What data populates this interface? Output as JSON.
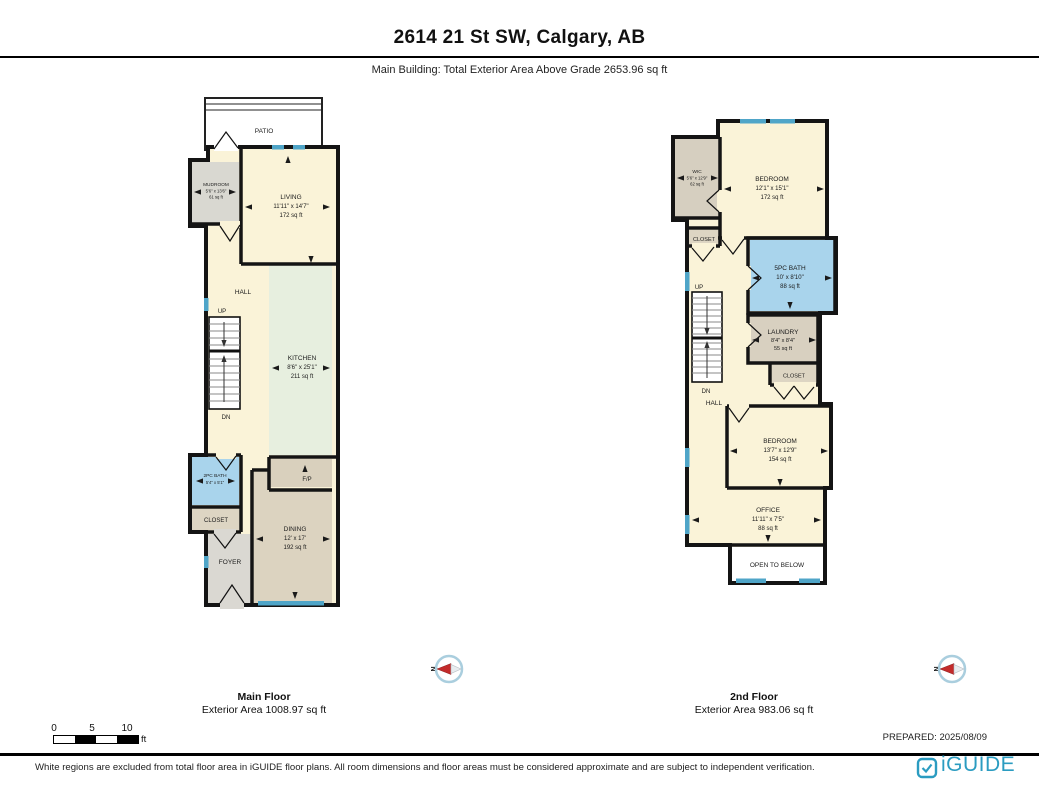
{
  "header": {
    "title": "2614 21 St SW, Calgary, AB",
    "subtitle": "Main Building: Total Exterior Area Above Grade 2653.96 sq ft"
  },
  "floors": {
    "main": {
      "name": "Main Floor",
      "exterior_area": "Exterior Area 1008.97 sq ft",
      "up": "UP",
      "dn": "DN",
      "rooms": {
        "patio": {
          "name": "PATIO"
        },
        "mudroom": {
          "name": "MUDROOM",
          "dims": "5'6\" x 13'6\"",
          "area": "61 sq ft"
        },
        "living": {
          "name": "LIVING",
          "dims": "11'11\" x 14'7\"",
          "area": "172 sq ft"
        },
        "hall": {
          "name": "HALL"
        },
        "kitchen": {
          "name": "KITCHEN",
          "dims": "8'6\" x 25'1\"",
          "area": "211 sq ft"
        },
        "fireplace": {
          "name": "F/P"
        },
        "bath": {
          "name": "2PC BATH",
          "dims": "5'4\" x 5'1\""
        },
        "closet": {
          "name": "CLOSET"
        },
        "foyer": {
          "name": "FOYER"
        },
        "dining": {
          "name": "DINING",
          "dims": "12' x 17'",
          "area": "192 sq ft"
        }
      }
    },
    "second": {
      "name": "2nd Floor",
      "exterior_area": "Exterior Area 983.06 sq ft",
      "up": "UP",
      "dn": "DN",
      "rooms": {
        "wic": {
          "name": "WIC",
          "dims": "5'6\" x 12'9\"",
          "area": "62 sq ft"
        },
        "bedroom1": {
          "name": "BEDROOM",
          "dims": "12'1\" x 15'1\"",
          "area": "172 sq ft"
        },
        "closet1": {
          "name": "CLOSET"
        },
        "bath": {
          "name": "5PC BATH",
          "dims": "10' x 8'10\"",
          "area": "88 sq ft"
        },
        "hall": {
          "name": "HALL"
        },
        "laundry": {
          "name": "LAUNDRY",
          "dims": "8'4\" x 8'4\"",
          "area": "55 sq ft"
        },
        "closet2": {
          "name": "CLOSET"
        },
        "bedroom2": {
          "name": "BEDROOM",
          "dims": "13'7\" x 12'9\"",
          "area": "154 sq ft"
        },
        "office": {
          "name": "OFFICE",
          "dims": "11'11\" x 7'5\"",
          "area": "88 sq ft"
        },
        "open_below": {
          "name": "OPEN TO BELOW"
        }
      }
    }
  },
  "compass": {
    "north_label": "N"
  },
  "scale_bar": {
    "ticks": [
      "0",
      "5",
      "10"
    ],
    "unit": "ft"
  },
  "prepared": "PREPARED: 2025/08/09",
  "footer": {
    "disclaimer": "White regions are excluded from total floor area in iGUIDE floor plans. All room dimensions and floor areas must be considered approximate and are subject to independent verification.",
    "brand": "iGUIDE"
  },
  "colors": {
    "brand": "#2b9cc1",
    "window": "#4fa5c8",
    "bath_fill": "#a9d4ec",
    "floor_cream": "#faf3d8",
    "wall": "#141414"
  }
}
